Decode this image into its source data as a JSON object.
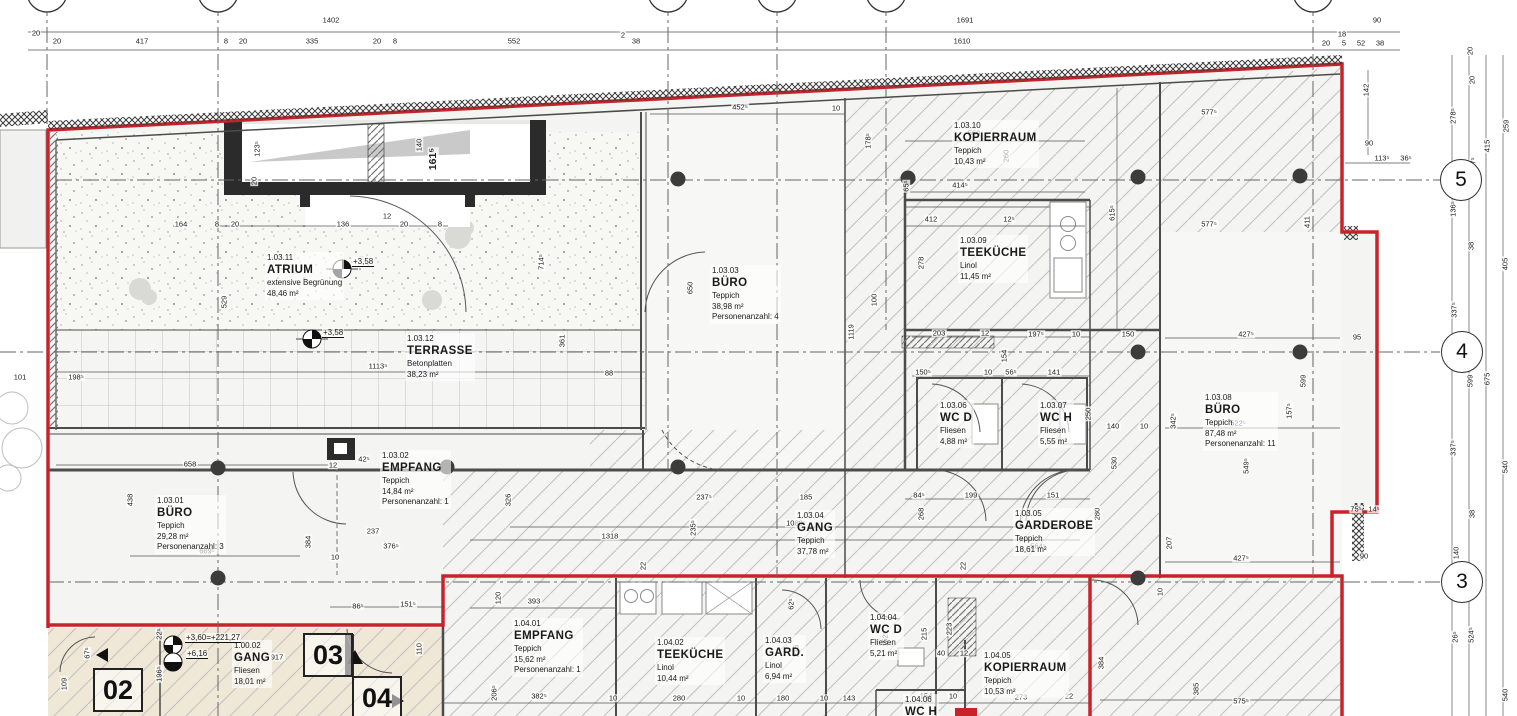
{
  "sheet": {
    "accent_red": "#c8232b",
    "beige": "#efe8d6",
    "paper": "#ffffff"
  },
  "rooms": [
    {
      "id": "1.03.11",
      "name": "ATRIUM",
      "lines": [
        "extensive Begrünung",
        "48,46 m²"
      ],
      "x": 265,
      "y": 252
    },
    {
      "id": "1.03.12",
      "name": "TERRASSE",
      "lines": [
        "Betonplatten",
        "38,23 m²"
      ],
      "x": 405,
      "y": 333
    },
    {
      "id": "1.03.03",
      "name": "BÜRO",
      "lines": [
        "Teppich",
        "38,98 m²",
        "Personenanzahl: 4"
      ],
      "x": 710,
      "y": 265
    },
    {
      "id": "1.03.10",
      "name": "KOPIERRAUM",
      "lines": [
        "Teppich",
        "10,43 m²"
      ],
      "x": 952,
      "y": 120
    },
    {
      "id": "1.03.09",
      "name": "TEEKÜCHE",
      "lines": [
        "Linol",
        "11,45 m²"
      ],
      "x": 958,
      "y": 235
    },
    {
      "id": "1.03.06",
      "name": "WC D",
      "lines": [
        "Fliesen",
        "4,88 m²"
      ],
      "x": 938,
      "y": 400
    },
    {
      "id": "1.03.07",
      "name": "WC H",
      "lines": [
        "Fliesen",
        "5,55 m²"
      ],
      "x": 1038,
      "y": 400
    },
    {
      "id": "1.03.08",
      "name": "BÜRO",
      "lines": [
        "Teppich",
        "87,48 m²",
        "Personenanzahl: 11"
      ],
      "x": 1203,
      "y": 392
    },
    {
      "id": "1.03.01",
      "name": "BÜRO",
      "lines": [
        "Teppich",
        "29,28 m²",
        "Personenanzahl: 3"
      ],
      "x": 155,
      "y": 495
    },
    {
      "id": "1.03.02",
      "name": "EMPFANG",
      "lines": [
        "Teppich",
        "14,84 m²",
        "Personenanzahl: 1"
      ],
      "x": 380,
      "y": 450
    },
    {
      "id": "1.03.04",
      "name": "GANG",
      "lines": [
        "Teppich",
        "37,78 m²"
      ],
      "x": 795,
      "y": 510
    },
    {
      "id": "1.03.05",
      "name": "GARDEROBE",
      "lines": [
        "Teppich",
        "18,61 m²"
      ],
      "x": 1013,
      "y": 508
    },
    {
      "id": "1.00.02",
      "name": "GANG",
      "lines": [
        "Fliesen",
        "18,01 m²"
      ],
      "x": 232,
      "y": 640
    },
    {
      "id": "1.04.01",
      "name": "EMPFANG",
      "lines": [
        "Teppich",
        "15,62 m²",
        "Personenanzahl: 1"
      ],
      "x": 512,
      "y": 618
    },
    {
      "id": "1.04.02",
      "name": "TEEKÜCHE",
      "lines": [
        "Linol",
        "10,44 m²"
      ],
      "x": 655,
      "y": 637
    },
    {
      "id": "1.04.03",
      "name": "GARD.",
      "lines": [
        "Linol",
        "6,94 m²"
      ],
      "x": 763,
      "y": 635
    },
    {
      "id": "1.04.04",
      "name": "WC D",
      "lines": [
        "Fliesen",
        "5,21 m²"
      ],
      "x": 868,
      "y": 612
    },
    {
      "id": "1.04.05",
      "name": "KOPIERRAUM",
      "lines": [
        "Teppich",
        "10,53 m²"
      ],
      "x": 982,
      "y": 650
    },
    {
      "id": "1.04.06",
      "name": "WC H",
      "lines": [],
      "x": 903,
      "y": 694
    }
  ],
  "grid_bubbles": [
    {
      "label": "5",
      "x": 1461,
      "y": 180
    },
    {
      "label": "4",
      "x": 1462,
      "y": 352
    },
    {
      "label": "3",
      "x": 1462,
      "y": 582
    }
  ],
  "door_numbers": [
    {
      "label": "02",
      "x": 93,
      "y": 668
    },
    {
      "label": "03",
      "x": 303,
      "y": 633
    },
    {
      "label": "04",
      "x": 352,
      "y": 676
    }
  ],
  "levels": [
    {
      "text": "+3,58",
      "x": 352,
      "y": 262
    },
    {
      "text": "+3,58",
      "x": 322,
      "y": 333
    },
    {
      "text": "+3,60=+221,27",
      "x": 185,
      "y": 638
    },
    {
      "text": "+6,16",
      "x": 186,
      "y": 654
    }
  ],
  "dims": [
    {
      "t": "1402",
      "x": 331,
      "y": 20
    },
    {
      "t": "1691",
      "x": 965,
      "y": 20
    },
    {
      "t": "90",
      "x": 1377,
      "y": 20
    },
    {
      "t": "20",
      "x": 36,
      "y": 33
    },
    {
      "t": "20",
      "x": 57,
      "y": 41
    },
    {
      "t": "417",
      "x": 142,
      "y": 41
    },
    {
      "t": "8",
      "x": 226,
      "y": 41
    },
    {
      "t": "20",
      "x": 243,
      "y": 41
    },
    {
      "t": "335",
      "x": 312,
      "y": 41
    },
    {
      "t": "20",
      "x": 377,
      "y": 41
    },
    {
      "t": "8",
      "x": 395,
      "y": 41
    },
    {
      "t": "552",
      "x": 514,
      "y": 41
    },
    {
      "t": "2",
      "x": 623,
      "y": 35
    },
    {
      "t": "38",
      "x": 636,
      "y": 41
    },
    {
      "t": "1610",
      "x": 962,
      "y": 41
    },
    {
      "t": "18",
      "x": 1342,
      "y": 34
    },
    {
      "t": "20",
      "x": 1326,
      "y": 43
    },
    {
      "t": "5",
      "x": 1344,
      "y": 43
    },
    {
      "t": "52",
      "x": 1361,
      "y": 43
    },
    {
      "t": "38",
      "x": 1380,
      "y": 43
    },
    {
      "t": "142",
      "x": 1366,
      "y": 90,
      "v": 1
    },
    {
      "t": "90",
      "x": 1369,
      "y": 143
    },
    {
      "t": "113⁵",
      "x": 1382,
      "y": 158
    },
    {
      "t": "36⁵",
      "x": 1406,
      "y": 158
    },
    {
      "t": "20",
      "x": 1470,
      "y": 51,
      "v": 1
    },
    {
      "t": "20",
      "x": 1472,
      "y": 80,
      "v": 1
    },
    {
      "t": "278⁵",
      "x": 1453,
      "y": 116,
      "v": 1
    },
    {
      "t": "259",
      "x": 1506,
      "y": 126,
      "v": 1
    },
    {
      "t": "415",
      "x": 1487,
      "y": 146,
      "v": 1
    },
    {
      "t": "37⁵",
      "x": 1473,
      "y": 163,
      "v": 1
    },
    {
      "t": "136⁵",
      "x": 1453,
      "y": 209,
      "v": 1
    },
    {
      "t": "38",
      "x": 1471,
      "y": 246,
      "v": 1
    },
    {
      "t": "405",
      "x": 1505,
      "y": 264,
      "v": 1
    },
    {
      "t": "337⁵",
      "x": 1454,
      "y": 310,
      "v": 1
    },
    {
      "t": "599",
      "x": 1470,
      "y": 381,
      "v": 1
    },
    {
      "t": "675",
      "x": 1487,
      "y": 379,
      "v": 1
    },
    {
      "t": "337⁵",
      "x": 1453,
      "y": 448,
      "v": 1
    },
    {
      "t": "540",
      "x": 1505,
      "y": 467,
      "v": 1
    },
    {
      "t": "38",
      "x": 1472,
      "y": 514,
      "v": 1
    },
    {
      "t": "140",
      "x": 1456,
      "y": 553,
      "v": 1
    },
    {
      "t": "26⁵",
      "x": 1455,
      "y": 637,
      "v": 1
    },
    {
      "t": "524⁵",
      "x": 1471,
      "y": 635,
      "v": 1
    },
    {
      "t": "540",
      "x": 1505,
      "y": 695,
      "v": 1
    },
    {
      "t": "452⁵",
      "x": 740,
      "y": 107
    },
    {
      "t": "10",
      "x": 836,
      "y": 108
    },
    {
      "t": "560",
      "x": 974,
      "y": 133
    },
    {
      "t": "178⁵",
      "x": 868,
      "y": 141,
      "v": 1
    },
    {
      "t": "414⁵",
      "x": 960,
      "y": 185
    },
    {
      "t": "65⁵",
      "x": 906,
      "y": 186,
      "v": 1
    },
    {
      "t": "412",
      "x": 931,
      "y": 219
    },
    {
      "t": "12⁵",
      "x": 1009,
      "y": 219
    },
    {
      "t": "615⁵",
      "x": 1112,
      "y": 213,
      "v": 1
    },
    {
      "t": "260",
      "x": 1006,
      "y": 156,
      "v": 1
    },
    {
      "t": "278",
      "x": 921,
      "y": 263,
      "v": 1
    },
    {
      "t": "577⁵",
      "x": 1209,
      "y": 112
    },
    {
      "t": "577⁵",
      "x": 1209,
      "y": 224
    },
    {
      "t": "411",
      "x": 1307,
      "y": 222,
      "v": 1
    },
    {
      "t": "95",
      "x": 1357,
      "y": 337
    },
    {
      "t": "123⁵",
      "x": 257,
      "y": 149,
      "v": 1
    },
    {
      "t": "20",
      "x": 254,
      "y": 181,
      "v": 1
    },
    {
      "t": "140",
      "x": 419,
      "y": 145,
      "v": 1
    },
    {
      "t": "161⁵",
      "x": 433,
      "y": 159,
      "v": 1,
      "b": 1
    },
    {
      "t": "8",
      "x": 217,
      "y": 224
    },
    {
      "t": "20",
      "x": 235,
      "y": 224
    },
    {
      "t": "164",
      "x": 181,
      "y": 224
    },
    {
      "t": "136",
      "x": 343,
      "y": 224
    },
    {
      "t": "12",
      "x": 387,
      "y": 216
    },
    {
      "t": "20",
      "x": 404,
      "y": 224
    },
    {
      "t": "8",
      "x": 440,
      "y": 224
    },
    {
      "t": "714⁵",
      "x": 541,
      "y": 262,
      "v": 1
    },
    {
      "t": "361",
      "x": 562,
      "y": 341,
      "v": 1
    },
    {
      "t": "529",
      "x": 224,
      "y": 302,
      "v": 1
    },
    {
      "t": "1113⁵",
      "x": 378,
      "y": 366
    },
    {
      "t": "88",
      "x": 609,
      "y": 373
    },
    {
      "t": "198⁵",
      "x": 76,
      "y": 377
    },
    {
      "t": "101",
      "x": 20,
      "y": 377
    },
    {
      "t": "658",
      "x": 190,
      "y": 464
    },
    {
      "t": "42⁵",
      "x": 364,
      "y": 459
    },
    {
      "t": "12",
      "x": 333,
      "y": 465
    },
    {
      "t": "384",
      "x": 308,
      "y": 542,
      "v": 1
    },
    {
      "t": "669⁵",
      "x": 207,
      "y": 551
    },
    {
      "t": "237",
      "x": 373,
      "y": 531
    },
    {
      "t": "376⁵",
      "x": 391,
      "y": 546
    },
    {
      "t": "438",
      "x": 130,
      "y": 500,
      "v": 1
    },
    {
      "t": "10",
      "x": 335,
      "y": 557
    },
    {
      "t": "326",
      "x": 508,
      "y": 500,
      "v": 1
    },
    {
      "t": "650",
      "x": 690,
      "y": 288,
      "v": 1
    },
    {
      "t": "1119",
      "x": 851,
      "y": 332,
      "v": 1
    },
    {
      "t": "100",
      "x": 874,
      "y": 300,
      "v": 1
    },
    {
      "t": "1318",
      "x": 610,
      "y": 536
    },
    {
      "t": "1080⁵",
      "x": 796,
      "y": 523
    },
    {
      "t": "235⁵",
      "x": 693,
      "y": 528,
      "v": 1
    },
    {
      "t": "237⁵",
      "x": 704,
      "y": 497
    },
    {
      "t": "185",
      "x": 806,
      "y": 497
    },
    {
      "t": "22",
      "x": 643,
      "y": 566,
      "v": 1
    },
    {
      "t": "22",
      "x": 963,
      "y": 566,
      "v": 1
    },
    {
      "t": "203",
      "x": 939,
      "y": 333
    },
    {
      "t": "12",
      "x": 985,
      "y": 333
    },
    {
      "t": "197⁵",
      "x": 1036,
      "y": 334
    },
    {
      "t": "10",
      "x": 1076,
      "y": 334
    },
    {
      "t": "150⁵",
      "x": 923,
      "y": 372
    },
    {
      "t": "10",
      "x": 988,
      "y": 372
    },
    {
      "t": "56⁵",
      "x": 1011,
      "y": 372
    },
    {
      "t": "141",
      "x": 1054,
      "y": 372
    },
    {
      "t": "154",
      "x": 1004,
      "y": 356,
      "v": 1
    },
    {
      "t": "250",
      "x": 1088,
      "y": 414,
      "v": 1
    },
    {
      "t": "84⁵",
      "x": 919,
      "y": 495
    },
    {
      "t": "199",
      "x": 971,
      "y": 495
    },
    {
      "t": "151",
      "x": 1053,
      "y": 495
    },
    {
      "t": "530",
      "x": 1114,
      "y": 463,
      "v": 1
    },
    {
      "t": "140",
      "x": 1113,
      "y": 426
    },
    {
      "t": "10",
      "x": 1144,
      "y": 426
    },
    {
      "t": "342⁵",
      "x": 1173,
      "y": 421,
      "v": 1
    },
    {
      "t": "150",
      "x": 1128,
      "y": 334
    },
    {
      "t": "522⁵",
      "x": 1238,
      "y": 423
    },
    {
      "t": "549⁵",
      "x": 1246,
      "y": 466,
      "v": 1
    },
    {
      "t": "157⁵",
      "x": 1289,
      "y": 411,
      "v": 1
    },
    {
      "t": "599",
      "x": 1303,
      "y": 381,
      "v": 1
    },
    {
      "t": "427⁵",
      "x": 1246,
      "y": 334
    },
    {
      "t": "427⁵",
      "x": 1241,
      "y": 558
    },
    {
      "t": "207",
      "x": 1169,
      "y": 543,
      "v": 1
    },
    {
      "t": "90",
      "x": 1364,
      "y": 556
    },
    {
      "t": "75⁵",
      "x": 1356,
      "y": 509
    },
    {
      "t": "14⁵",
      "x": 1374,
      "y": 509
    },
    {
      "t": "268",
      "x": 921,
      "y": 514,
      "v": 1
    },
    {
      "t": "564⁵",
      "x": 1038,
      "y": 546
    },
    {
      "t": "280",
      "x": 1097,
      "y": 514,
      "v": 1
    },
    {
      "t": "393",
      "x": 534,
      "y": 601
    },
    {
      "t": "120",
      "x": 498,
      "y": 598,
      "v": 1
    },
    {
      "t": "86⁵",
      "x": 358,
      "y": 606
    },
    {
      "t": "151⁵",
      "x": 408,
      "y": 604
    },
    {
      "t": "382⁵",
      "x": 539,
      "y": 696
    },
    {
      "t": "206⁵",
      "x": 494,
      "y": 693,
      "v": 1
    },
    {
      "t": "10",
      "x": 613,
      "y": 698
    },
    {
      "t": "280",
      "x": 679,
      "y": 698
    },
    {
      "t": "10",
      "x": 741,
      "y": 698
    },
    {
      "t": "180",
      "x": 783,
      "y": 698
    },
    {
      "t": "10",
      "x": 824,
      "y": 698
    },
    {
      "t": "143",
      "x": 849,
      "y": 698
    },
    {
      "t": "216",
      "x": 796,
      "y": 651,
      "v": 1
    },
    {
      "t": "62⁵",
      "x": 791,
      "y": 604,
      "v": 1
    },
    {
      "t": "215",
      "x": 924,
      "y": 634,
      "v": 1
    },
    {
      "t": "223",
      "x": 949,
      "y": 629,
      "v": 1
    },
    {
      "t": "152⁵",
      "x": 885,
      "y": 639,
      "v": 1
    },
    {
      "t": "40",
      "x": 941,
      "y": 653
    },
    {
      "t": "12",
      "x": 964,
      "y": 653
    },
    {
      "t": "154",
      "x": 926,
      "y": 696
    },
    {
      "t": "10",
      "x": 953,
      "y": 696
    },
    {
      "t": "273",
      "x": 1021,
      "y": 697
    },
    {
      "t": "22",
      "x": 1069,
      "y": 696
    },
    {
      "t": "575⁵",
      "x": 1241,
      "y": 701
    },
    {
      "t": "384",
      "x": 1101,
      "y": 663,
      "v": 1
    },
    {
      "t": "385",
      "x": 1196,
      "y": 689,
      "v": 1
    },
    {
      "t": "10",
      "x": 1160,
      "y": 592,
      "v": 1
    },
    {
      "t": "917",
      "x": 277,
      "y": 657
    },
    {
      "t": "109",
      "x": 64,
      "y": 684,
      "v": 1
    },
    {
      "t": "67⁵",
      "x": 87,
      "y": 653,
      "v": 1
    },
    {
      "t": "22⁵",
      "x": 159,
      "y": 634,
      "v": 1
    },
    {
      "t": "196⁵",
      "x": 159,
      "y": 674,
      "v": 1
    },
    {
      "t": "110",
      "x": 419,
      "y": 649,
      "v": 1
    }
  ]
}
